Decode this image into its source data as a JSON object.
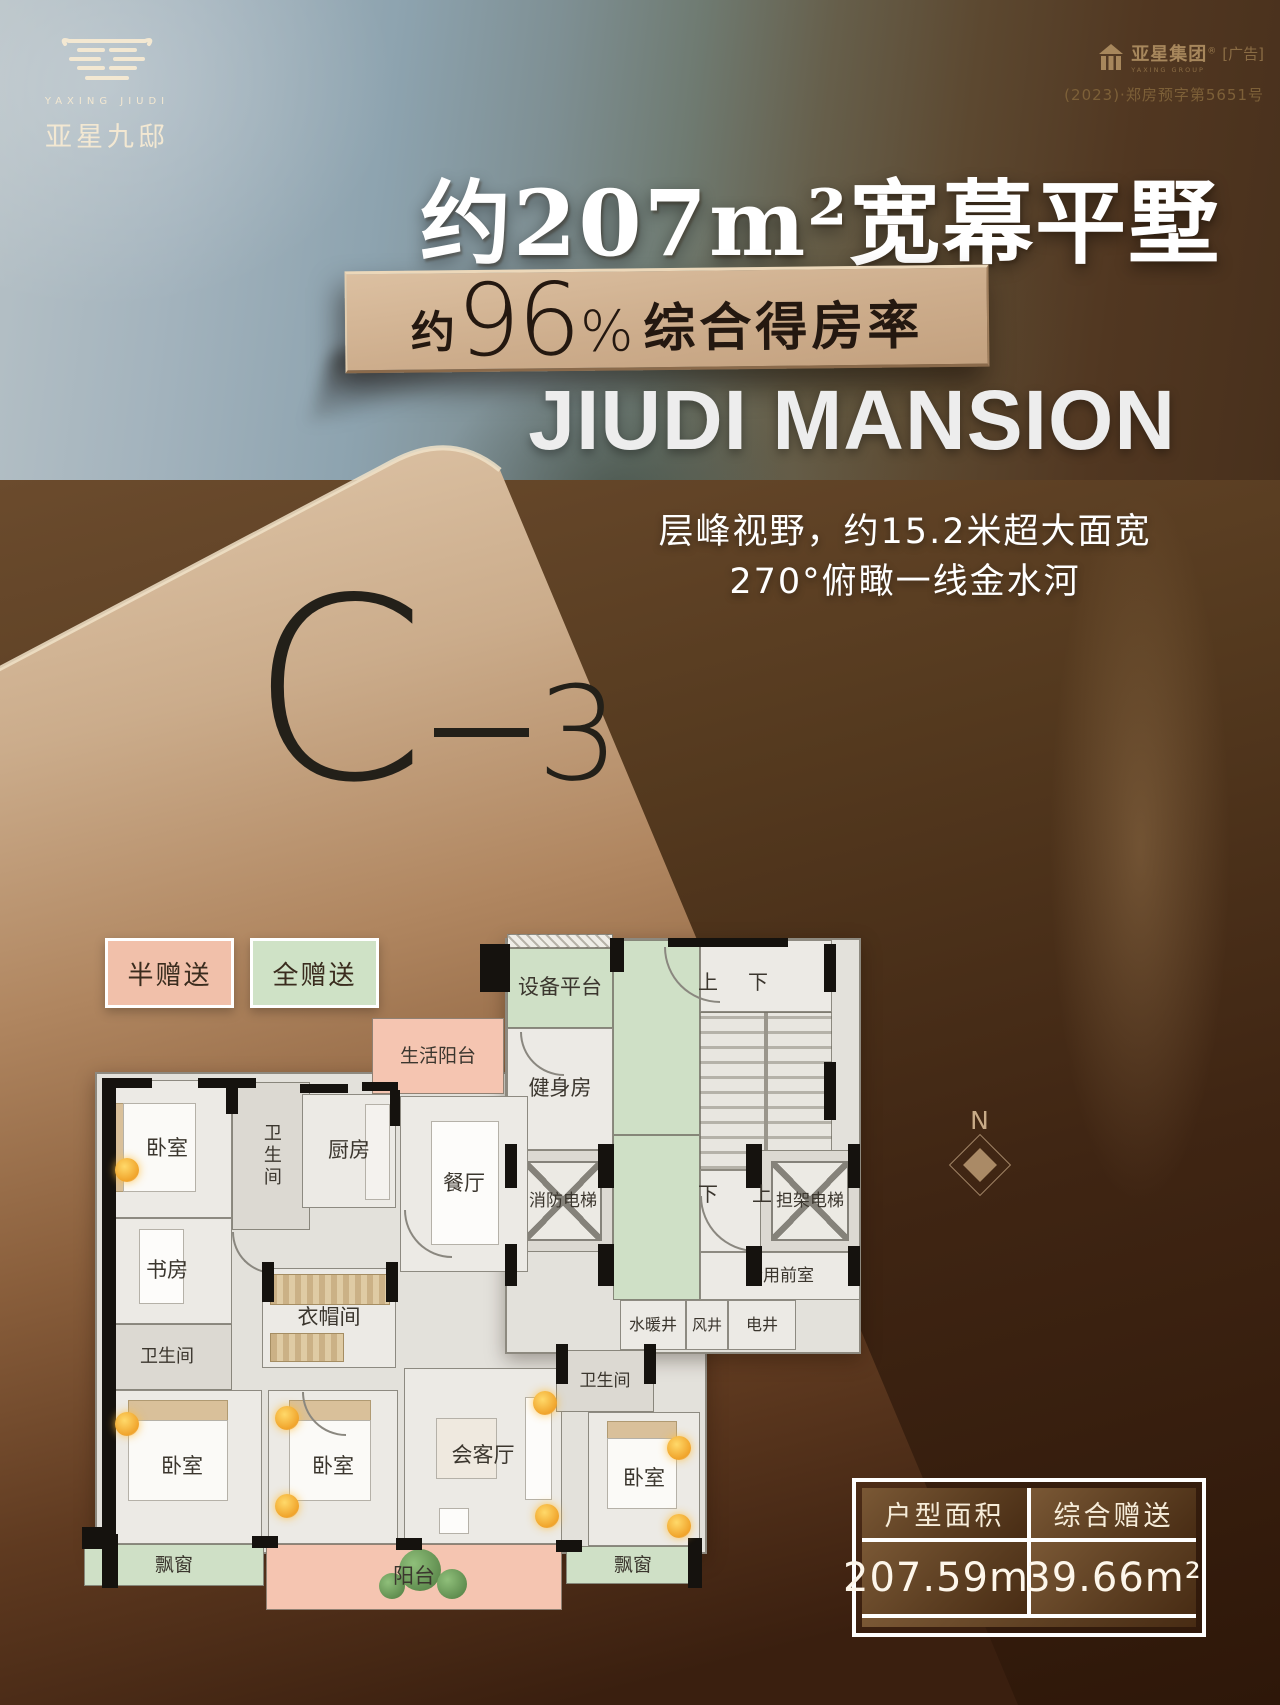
{
  "brand": {
    "latin": "YAXING JIUDI",
    "cn": "亚星九邸"
  },
  "corner": {
    "group_cn": "亚星集团",
    "reg": "®",
    "group_en": "YAXING GROUP",
    "ad": "[广告]",
    "permit": "(2023)·郑房预字第5651号"
  },
  "headline": {
    "text": "约207m²宽幕平墅"
  },
  "banner": {
    "about": "约",
    "percent": "96",
    "sign": "%",
    "text": "综合得房率"
  },
  "subtitle_en": "JIUDI MANSION",
  "description": {
    "line1": "层峰视野，约15.2米超大面宽",
    "line2": "270°俯瞰一线金水河"
  },
  "unit": {
    "letter": "C",
    "number": "3"
  },
  "legend": {
    "half": {
      "label": "半赠送",
      "color": "#f1c0aa"
    },
    "full": {
      "label": "全赠送",
      "color": "#cfe2c6"
    }
  },
  "compass": {
    "label": "N"
  },
  "summary_table": {
    "headers": [
      "户型面积",
      "综合赠送"
    ],
    "values": [
      "207.59m²",
      "39.66m²"
    ]
  },
  "accents": {
    "card_top": "#dcc2a4",
    "card_bottom": "#3a1f0f",
    "plaque": "#cdad8c",
    "gold_text": "#9a7a4e",
    "cream": "#f3e8d2"
  },
  "floorplan": {
    "colors": {
      "white": "#eceae5",
      "grey": "#dcd9d2",
      "green": "#cfe0c6",
      "pink": "#f5c5b1",
      "floor": "#e3e1db"
    },
    "rooms": [
      {
        "n": "floor-base-a",
        "x": 95,
        "y": 1072,
        "w": 612,
        "h": 482,
        "c": "floor"
      },
      {
        "n": "floor-base-b",
        "x": 505,
        "y": 938,
        "w": 356,
        "h": 416,
        "c": "floor"
      },
      {
        "n": "vent-hatch",
        "x": 507,
        "y": 934,
        "w": 106,
        "h": 14,
        "t": "hatch"
      },
      {
        "n": "equipment-platform",
        "l": "设备平台",
        "x": 507,
        "y": 948,
        "w": 106,
        "h": 80,
        "c": "green"
      },
      {
        "n": "gym",
        "l": "健身房",
        "x": 507,
        "y": 1028,
        "w": 106,
        "h": 122,
        "c": "white"
      },
      {
        "n": "corridor-green-1",
        "x": 613,
        "y": 940,
        "w": 87,
        "h": 195,
        "c": "green"
      },
      {
        "n": "corridor-green-2",
        "x": 613,
        "y": 1135,
        "w": 87,
        "h": 165,
        "c": "green"
      },
      {
        "n": "stair-landing-top",
        "x": 700,
        "y": 940,
        "w": 132,
        "h": 72,
        "c": "white"
      },
      {
        "n": "stairs",
        "x": 700,
        "y": 1012,
        "w": 132,
        "h": 158,
        "t": "stairs"
      },
      {
        "n": "stair-landing-bottom",
        "x": 700,
        "y": 1170,
        "w": 132,
        "h": 82,
        "c": "white"
      },
      {
        "n": "fire-elevator",
        "l": "消防电梯",
        "fs": 17,
        "x": 513,
        "y": 1150,
        "w": 100,
        "h": 102,
        "c": "grey",
        "t": "elevator"
      },
      {
        "n": "stretcher-elevator",
        "l": "担架电梯",
        "fs": 17,
        "x": 760,
        "y": 1150,
        "w": 100,
        "h": 102,
        "c": "grey",
        "t": "elevator"
      },
      {
        "n": "shared-front-room",
        "l": "合用前室",
        "fs": 17,
        "x": 700,
        "y": 1252,
        "w": 160,
        "h": 48,
        "c": "white"
      },
      {
        "n": "shaft-water",
        "l": "水暖井",
        "fs": 16,
        "x": 620,
        "y": 1300,
        "w": 66,
        "h": 50,
        "c": "white"
      },
      {
        "n": "shaft-wind",
        "l": "风井",
        "fs": 15,
        "x": 686,
        "y": 1300,
        "w": 42,
        "h": 50,
        "c": "white"
      },
      {
        "n": "shaft-elec",
        "l": "电井",
        "fs": 16,
        "x": 728,
        "y": 1300,
        "w": 68,
        "h": 50,
        "c": "white"
      },
      {
        "n": "bedroom-nw",
        "l": "卧室",
        "x": 102,
        "y": 1080,
        "w": 130,
        "h": 138,
        "c": "white",
        "t": "bed-l"
      },
      {
        "n": "bath-north",
        "l": "卫生间",
        "fs": 18,
        "x": 232,
        "y": 1082,
        "w": 78,
        "h": 148,
        "c": "grey",
        "v": 1
      },
      {
        "n": "kitchen",
        "l": "厨房",
        "x": 302,
        "y": 1094,
        "w": 94,
        "h": 114,
        "c": "white",
        "t": "counter"
      },
      {
        "n": "living-balcony",
        "l": "生活阳台",
        "fs": 19,
        "x": 372,
        "y": 1018,
        "w": 132,
        "h": 76,
        "c": "pink"
      },
      {
        "n": "dining",
        "l": "餐厅",
        "x": 400,
        "y": 1096,
        "w": 128,
        "h": 176,
        "c": "white",
        "t": "table"
      },
      {
        "n": "study",
        "l": "书房",
        "x": 102,
        "y": 1218,
        "w": 130,
        "h": 106,
        "c": "white",
        "t": "desk"
      },
      {
        "n": "bath-west",
        "l": "卫生间",
        "fs": 18,
        "x": 102,
        "y": 1324,
        "w": 130,
        "h": 66,
        "c": "grey"
      },
      {
        "n": "cloakroom",
        "l": "衣帽间",
        "x": 262,
        "y": 1268,
        "w": 134,
        "h": 100,
        "c": "white",
        "t": "wardrobe"
      },
      {
        "n": "bedroom-sw",
        "l": "卧室",
        "x": 102,
        "y": 1390,
        "w": 160,
        "h": 154,
        "c": "white",
        "t": "bed-t"
      },
      {
        "n": "bedroom-s",
        "l": "卧室",
        "x": 268,
        "y": 1390,
        "w": 130,
        "h": 154,
        "c": "white",
        "t": "bed-t"
      },
      {
        "n": "reception",
        "l": "会客厅",
        "x": 404,
        "y": 1368,
        "w": 158,
        "h": 176,
        "c": "white",
        "t": "sofa"
      },
      {
        "n": "bath-south",
        "l": "卫生间",
        "fs": 17,
        "x": 556,
        "y": 1350,
        "w": 98,
        "h": 62,
        "c": "grey"
      },
      {
        "n": "bedroom-se",
        "l": "卧室",
        "x": 588,
        "y": 1412,
        "w": 112,
        "h": 134,
        "c": "white",
        "t": "bed-t"
      },
      {
        "n": "bay-window-west",
        "l": "飘窗",
        "fs": 19,
        "x": 84,
        "y": 1544,
        "w": 180,
        "h": 42,
        "c": "green"
      },
      {
        "n": "balcony",
        "l": "阳台",
        "x": 266,
        "y": 1544,
        "w": 296,
        "h": 66,
        "c": "pink",
        "t": "plants"
      },
      {
        "n": "bay-window-south",
        "l": "飘窗",
        "fs": 19,
        "x": 566,
        "y": 1546,
        "w": 134,
        "h": 38,
        "c": "green"
      }
    ],
    "stair_labels": [
      {
        "t": "上",
        "x": 698,
        "y": 966
      },
      {
        "t": "下",
        "x": 748,
        "y": 966
      },
      {
        "t": "下",
        "x": 698,
        "y": 1178
      },
      {
        "t": "上",
        "x": 752,
        "y": 1178
      }
    ],
    "walls": [
      [
        102,
        1078,
        14,
        302
      ],
      [
        102,
        1380,
        14,
        168
      ],
      [
        102,
        1078,
        50,
        10
      ],
      [
        198,
        1078,
        58,
        10
      ],
      [
        300,
        1084,
        48,
        9
      ],
      [
        362,
        1082,
        36,
        9
      ],
      [
        480,
        944,
        30,
        48
      ],
      [
        610,
        938,
        14,
        34
      ],
      [
        668,
        938,
        120,
        9
      ],
      [
        824,
        944,
        12,
        48
      ],
      [
        824,
        1062,
        12,
        58
      ],
      [
        505,
        1144,
        12,
        44
      ],
      [
        598,
        1144,
        16,
        44
      ],
      [
        505,
        1244,
        12,
        42
      ],
      [
        598,
        1244,
        16,
        42
      ],
      [
        746,
        1144,
        16,
        44
      ],
      [
        848,
        1144,
        12,
        44
      ],
      [
        746,
        1246,
        16,
        40
      ],
      [
        848,
        1246,
        12,
        40
      ],
      [
        556,
        1344,
        12,
        40
      ],
      [
        644,
        1344,
        12,
        40
      ],
      [
        102,
        1534,
        16,
        54
      ],
      [
        252,
        1536,
        26,
        12
      ],
      [
        396,
        1538,
        26,
        12
      ],
      [
        556,
        1540,
        26,
        12
      ],
      [
        688,
        1538,
        14,
        50
      ],
      [
        226,
        1078,
        12,
        36
      ],
      [
        390,
        1090,
        10,
        36
      ],
      [
        262,
        1262,
        12,
        40
      ],
      [
        386,
        1262,
        12,
        40
      ],
      [
        82,
        1527,
        25,
        22
      ]
    ],
    "arcs": [
      [
        664,
        947,
        54
      ],
      [
        520,
        1032,
        42
      ],
      [
        404,
        1210,
        46
      ],
      [
        700,
        1196,
        54
      ],
      [
        302,
        1392,
        42
      ],
      [
        232,
        1232,
        40
      ]
    ],
    "lights": [
      [
        127,
        1170
      ],
      [
        127,
        1424
      ],
      [
        287,
        1418
      ],
      [
        287,
        1506
      ],
      [
        545,
        1403
      ],
      [
        547,
        1516
      ],
      [
        679,
        1448
      ],
      [
        679,
        1526
      ]
    ]
  }
}
